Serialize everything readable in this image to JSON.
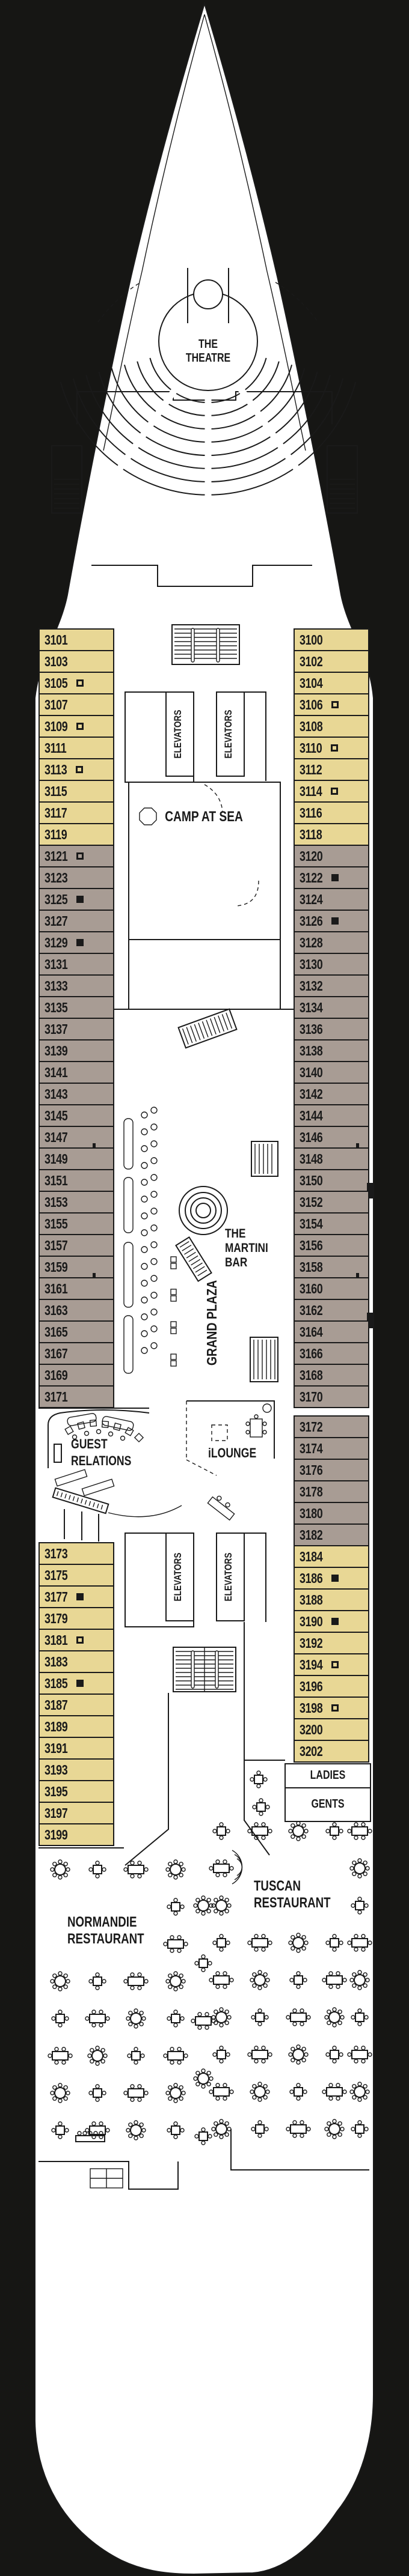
{
  "venues": {
    "theatre": "THE\nTHEATRE",
    "elevators": "ELEVATORS",
    "camp_at_sea": "CAMP AT SEA",
    "martini_bar": "THE\nMARTINI\nBAR",
    "grand_plaza": "GRAND PLAZA",
    "guest_relations": "GUEST\nRELATIONS",
    "ilounge": "iLOUNGE",
    "ladies": "LADIES",
    "gents": "GENTS",
    "tuscan": "TUSCAN\nRESTAURANT",
    "normandie": "NORMANDIE\nRESTAURANT"
  },
  "colors": {
    "background": "#161614",
    "hull": "#ffffff",
    "line": "#1a1a1a",
    "cabin_yellow": "#e8d795",
    "cabin_taupe": "#a89c94"
  },
  "cabins": {
    "port": [
      {
        "n": "3101",
        "cat": "y"
      },
      {
        "n": "3103",
        "cat": "y"
      },
      {
        "n": "3105",
        "cat": "y",
        "sym": "o"
      },
      {
        "n": "3107",
        "cat": "y"
      },
      {
        "n": "3109",
        "cat": "y",
        "sym": "o"
      },
      {
        "n": "3111",
        "cat": "y"
      },
      {
        "n": "3113",
        "cat": "y",
        "sym": "o"
      },
      {
        "n": "3115",
        "cat": "y"
      },
      {
        "n": "3117",
        "cat": "y"
      },
      {
        "n": "3119",
        "cat": "y"
      },
      {
        "n": "3121",
        "cat": "t",
        "sym": "o"
      },
      {
        "n": "3123",
        "cat": "t"
      },
      {
        "n": "3125",
        "cat": "t",
        "sym": "f"
      },
      {
        "n": "3127",
        "cat": "t"
      },
      {
        "n": "3129",
        "cat": "t",
        "sym": "f"
      },
      {
        "n": "3131",
        "cat": "t"
      },
      {
        "n": "3133",
        "cat": "t"
      },
      {
        "n": "3135",
        "cat": "t"
      },
      {
        "n": "3137",
        "cat": "t"
      },
      {
        "n": "3139",
        "cat": "t"
      },
      {
        "n": "3141",
        "cat": "t"
      },
      {
        "n": "3143",
        "cat": "t"
      },
      {
        "n": "3145",
        "cat": "t"
      },
      {
        "n": "3147",
        "cat": "t",
        "tick": 1
      },
      {
        "n": "3149",
        "cat": "t"
      },
      {
        "n": "3151",
        "cat": "t"
      },
      {
        "n": "3153",
        "cat": "t"
      },
      {
        "n": "3155",
        "cat": "t"
      },
      {
        "n": "3157",
        "cat": "t"
      },
      {
        "n": "3159",
        "cat": "t",
        "tick": 1
      },
      {
        "n": "3161",
        "cat": "t"
      },
      {
        "n": "3163",
        "cat": "t"
      },
      {
        "n": "3165",
        "cat": "t"
      },
      {
        "n": "3167",
        "cat": "t"
      },
      {
        "n": "3169",
        "cat": "t"
      },
      {
        "n": "3171",
        "cat": "t"
      },
      {
        "n": "3173",
        "cat": "y"
      },
      {
        "n": "3175",
        "cat": "y"
      },
      {
        "n": "3177",
        "cat": "y",
        "sym": "f"
      },
      {
        "n": "3179",
        "cat": "y"
      },
      {
        "n": "3181",
        "cat": "y",
        "sym": "o"
      },
      {
        "n": "3183",
        "cat": "y"
      },
      {
        "n": "3185",
        "cat": "y",
        "sym": "f"
      },
      {
        "n": "3187",
        "cat": "y"
      },
      {
        "n": "3189",
        "cat": "y"
      },
      {
        "n": "3191",
        "cat": "y"
      },
      {
        "n": "3193",
        "cat": "y"
      },
      {
        "n": "3195",
        "cat": "y"
      },
      {
        "n": "3197",
        "cat": "y"
      },
      {
        "n": "3199",
        "cat": "y"
      }
    ],
    "starboard": [
      {
        "n": "3100",
        "cat": "y"
      },
      {
        "n": "3102",
        "cat": "y"
      },
      {
        "n": "3104",
        "cat": "y"
      },
      {
        "n": "3106",
        "cat": "y",
        "sym": "o"
      },
      {
        "n": "3108",
        "cat": "y"
      },
      {
        "n": "3110",
        "cat": "y",
        "sym": "o"
      },
      {
        "n": "3112",
        "cat": "y"
      },
      {
        "n": "3114",
        "cat": "y",
        "sym": "o"
      },
      {
        "n": "3116",
        "cat": "y"
      },
      {
        "n": "3118",
        "cat": "y"
      },
      {
        "n": "3120",
        "cat": "t"
      },
      {
        "n": "3122",
        "cat": "t",
        "sym": "f"
      },
      {
        "n": "3124",
        "cat": "t"
      },
      {
        "n": "3126",
        "cat": "t",
        "sym": "f"
      },
      {
        "n": "3128",
        "cat": "t"
      },
      {
        "n": "3130",
        "cat": "t"
      },
      {
        "n": "3132",
        "cat": "t"
      },
      {
        "n": "3134",
        "cat": "t"
      },
      {
        "n": "3136",
        "cat": "t"
      },
      {
        "n": "3138",
        "cat": "t"
      },
      {
        "n": "3140",
        "cat": "t"
      },
      {
        "n": "3142",
        "cat": "t"
      },
      {
        "n": "3144",
        "cat": "t"
      },
      {
        "n": "3146",
        "cat": "t",
        "tick": 1
      },
      {
        "n": "3148",
        "cat": "t"
      },
      {
        "n": "3150",
        "cat": "t",
        "notch": 1
      },
      {
        "n": "3152",
        "cat": "t"
      },
      {
        "n": "3154",
        "cat": "t"
      },
      {
        "n": "3156",
        "cat": "t"
      },
      {
        "n": "3158",
        "cat": "t",
        "tick": 1
      },
      {
        "n": "3160",
        "cat": "t"
      },
      {
        "n": "3162",
        "cat": "t",
        "notch": 1
      },
      {
        "n": "3164",
        "cat": "t"
      },
      {
        "n": "3166",
        "cat": "t"
      },
      {
        "n": "3168",
        "cat": "t"
      },
      {
        "n": "3170",
        "cat": "t"
      },
      {
        "n": "3172",
        "cat": "t"
      },
      {
        "n": "3174",
        "cat": "t"
      },
      {
        "n": "3176",
        "cat": "t"
      },
      {
        "n": "3178",
        "cat": "t"
      },
      {
        "n": "3180",
        "cat": "t"
      },
      {
        "n": "3182",
        "cat": "t"
      },
      {
        "n": "3184",
        "cat": "y"
      },
      {
        "n": "3186",
        "cat": "y",
        "sym": "f"
      },
      {
        "n": "3188",
        "cat": "y"
      },
      {
        "n": "3190",
        "cat": "y",
        "sym": "f"
      },
      {
        "n": "3192",
        "cat": "y"
      },
      {
        "n": "3194",
        "cat": "y",
        "sym": "o"
      },
      {
        "n": "3196",
        "cat": "y"
      },
      {
        "n": "3198",
        "cat": "y",
        "sym": "o"
      },
      {
        "n": "3200",
        "cat": "y"
      },
      {
        "n": "3202",
        "cat": "y"
      }
    ]
  }
}
